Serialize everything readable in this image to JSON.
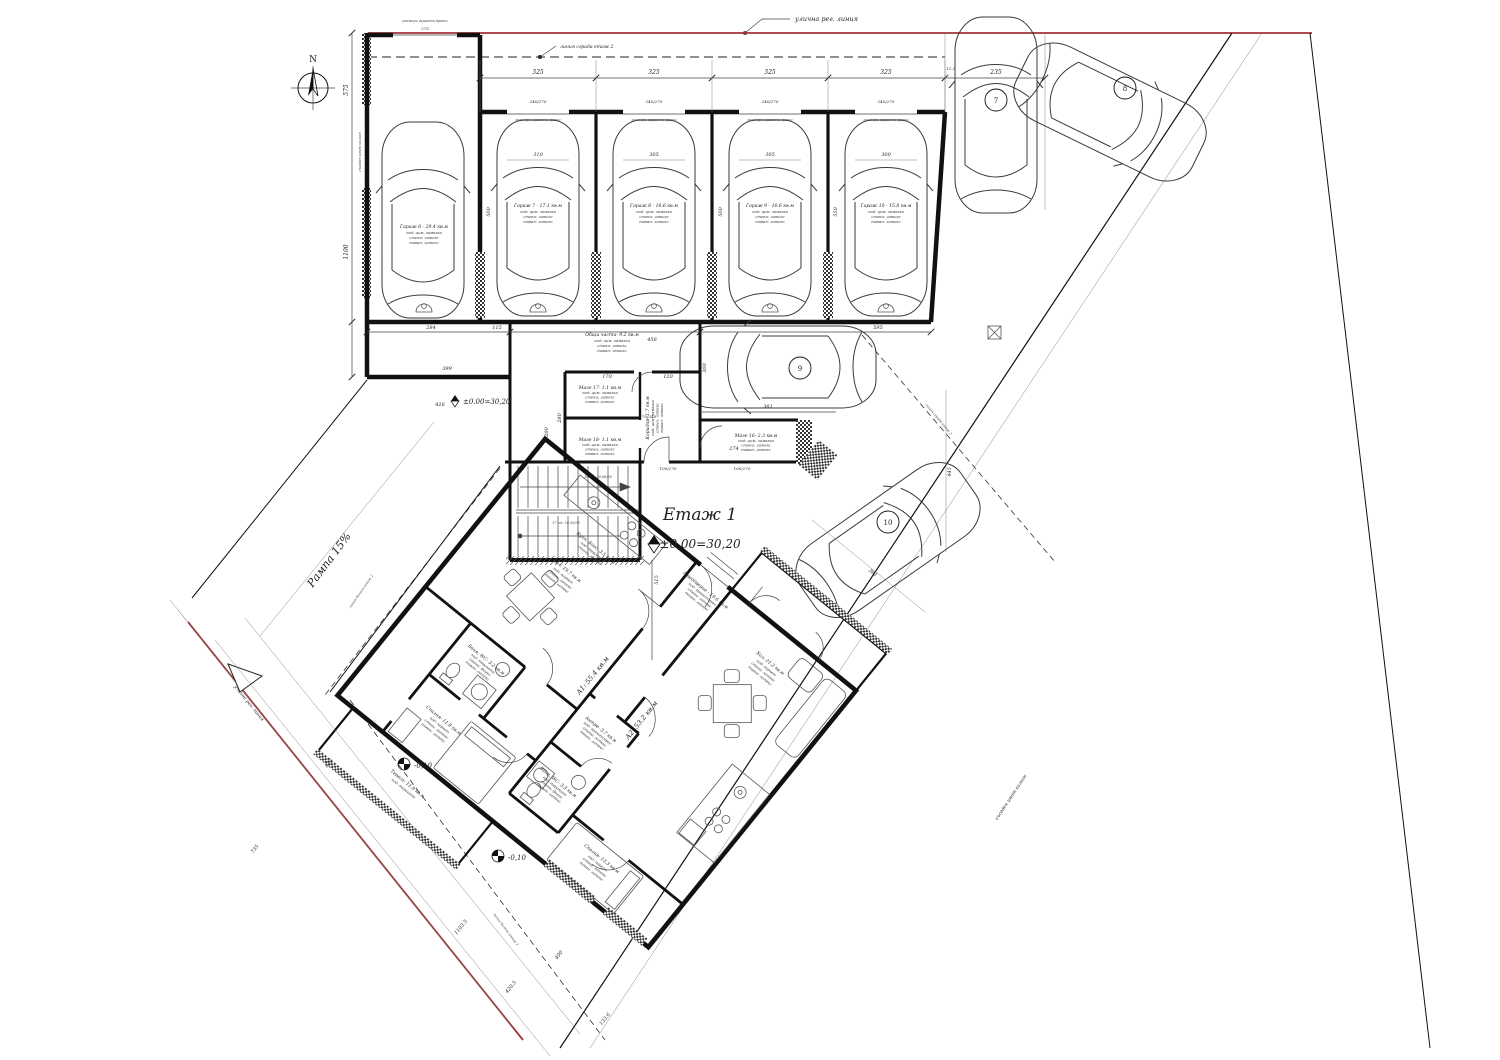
{
  "north": "N",
  "colors": {
    "boundary_red": "#a03232",
    "ink": "#111111"
  },
  "site": {
    "street_reg_top": "улична рег. линия",
    "street_reg_sw": "улична рег. линия",
    "build2_top": "линия сграда етаж 2",
    "build2_right": "линия сграда етаж 2",
    "balc2_left": "линия балкон етаж 2",
    "balc2_bottom": "линия балкон етаж 2",
    "neighbor_left": "съседен имот калкан",
    "neighbor_se": "съседен имот калкан",
    "ramp": "Рампа 15%",
    "gate_note": "размери гаражни врати"
  },
  "levels": {
    "floor_title": "Етаж 1",
    "floor_level": "±0,00=30,20",
    "entry_level": "±0.00=30,20",
    "minus": "-0,10"
  },
  "stairs": {
    "s1": "16 ст. 16,88/30",
    "s2": "17 ст. 16,58/30"
  },
  "fin": {
    "cem": "под: цим. замазка",
    "par": "под: паркет",
    "gran": "под: гранитогрес",
    "ter": "под: теракота",
    "lat": "стени: латекс",
    "fay": "стени: фаянс",
    "ceil": "таван: латекс"
  },
  "garages": [
    "Гараж 6 - 29.4 кв.м",
    "Гараж 7 - 17.1 кв.м",
    "Гараж 8 - 16.6 кв.м",
    "Гараж 9 - 16.6 кв.м",
    "Гараж 10 - 15.8 кв.м"
  ],
  "common": {
    "obshti": "Общи части- 9.2 кв.м",
    "maze17": "Мазе 17- 1.1 кв.м",
    "maze18": "Мазе 18- 1.1 кв.м",
    "koridor": "Коридор- 1.7 кв.м",
    "maze16": "Мазе 16- 2.3 кв.м"
  },
  "a1": {
    "tag": "А1: 55.4 кв.м",
    "hol": "Хол: 19.7 кв.м",
    "kitch": "Кухн. бокс- 3.5 кв.м",
    "bath": "Баня, WC- 3.2 кв.м",
    "bed": "Спалня- 11.8 кв.м",
    "ter": "Тераса- 11.9 кв.м"
  },
  "a2": {
    "tag": "А2: 53.2 кв.м",
    "hall": "Преддверие - 19.6 кв.м",
    "hol": "Хол: 21.2 кв.м",
    "antre": "Антре- 3.7 кв.м",
    "bath": "Баня, WC- 3.3 кв.м",
    "bed": "Спалня- 13.3 кв.м"
  },
  "parking": {
    "p7": "7",
    "p8": "8",
    "p9": "9",
    "p10": "10"
  },
  "dims": {
    "t1": "325",
    "t2": "325",
    "t3": "325",
    "t4": "325",
    "t5": "235",
    "t6": "12.5",
    "w1": "310",
    "w2": "305",
    "w3": "305",
    "w4": "300",
    "g0": "275",
    "g1": "240/270",
    "g2": "240/270",
    "g3": "240/270",
    "g4": "240/270",
    "v1": "575",
    "v2": "500",
    "v3": "500",
    "v4": "550",
    "v5": "445",
    "v6": "1100",
    "b1": "284",
    "b2": "115",
    "b3": "456",
    "b4": "595",
    "b5": "399",
    "b6": "426",
    "c1": "361",
    "c2": "515",
    "c3": "274",
    "c4": "300",
    "c5": "170",
    "c6": "120",
    "c7": "280",
    "c8": "200",
    "f1": "70/240",
    "f2": "100/270",
    "f3": "100/270",
    "dg1": "1103.5",
    "dg2": "420.5",
    "dg3": "400",
    "dg4": "133.6",
    "dg5": "735",
    "dg6": "823",
    "dg7": "361"
  }
}
